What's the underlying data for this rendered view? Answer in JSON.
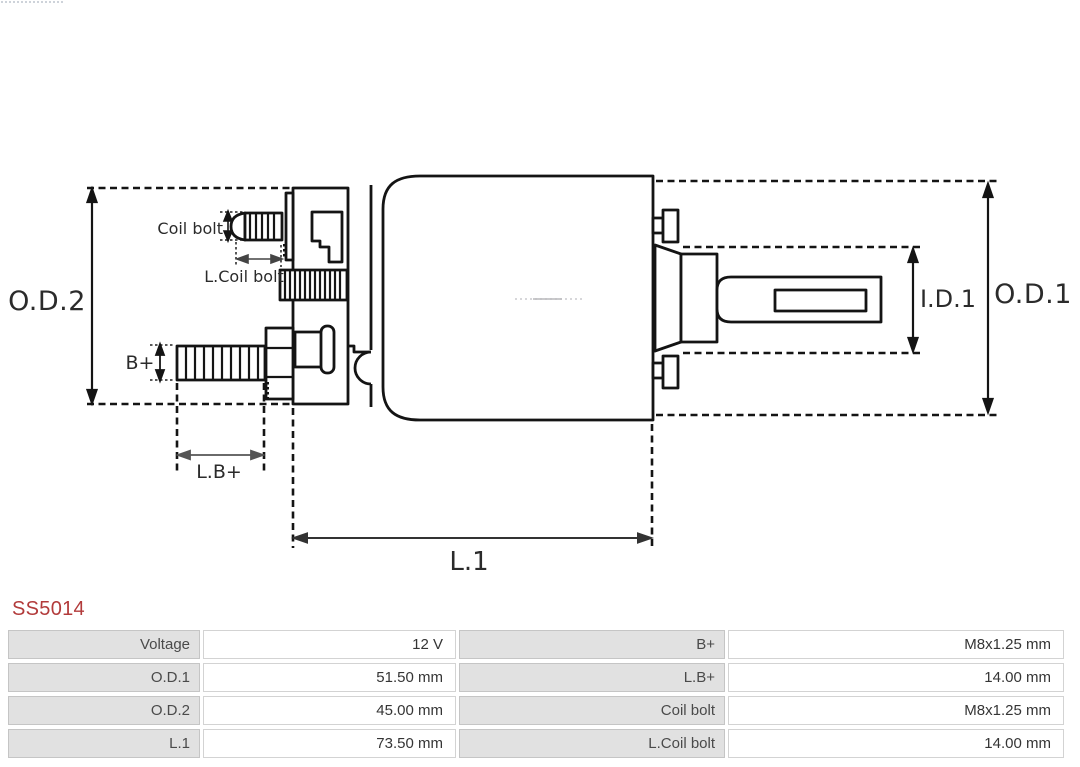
{
  "title": {
    "text": "SS5014",
    "color": "#b23b3b"
  },
  "diagram": {
    "line_color": "#141414",
    "labels": {
      "od2": "O.D.2",
      "od1": "O.D.1",
      "id1": "I.D.1",
      "l1": "L.1",
      "bplus": "B+",
      "lbplus": "L.B+",
      "coil_bolt": "Coil bolt",
      "lcoil_bolt": "L.Coil bolt"
    }
  },
  "table": {
    "label_bg": "#e1e1e1",
    "value_bg": "#ffffff",
    "border_color": "#c9c9c9",
    "rows": [
      {
        "c1": "Voltage",
        "c2": "12 V",
        "c3": "B+",
        "c4": "M8x1.25 mm"
      },
      {
        "c1": "O.D.1",
        "c2": "51.50 mm",
        "c3": "L.B+",
        "c4": "14.00 mm"
      },
      {
        "c1": "O.D.2",
        "c2": "45.00 mm",
        "c3": "Coil bolt",
        "c4": "M8x1.25 mm"
      },
      {
        "c1": "L.1",
        "c2": "73.50 mm",
        "c3": "L.Coil bolt",
        "c4": "14.00 mm"
      }
    ]
  }
}
